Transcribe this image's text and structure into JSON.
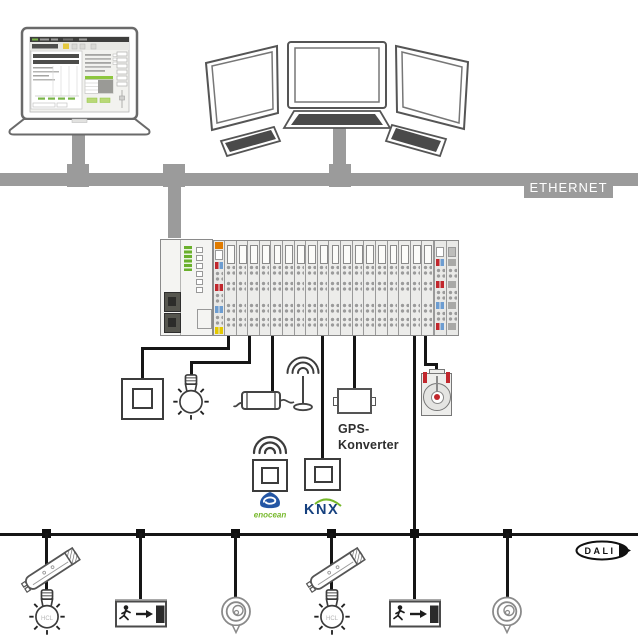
{
  "ethernet": {
    "label": "ETHERNET"
  },
  "gps_converter": {
    "label_line1": "GPS-",
    "label_line2": "Konverter"
  },
  "logos": {
    "enocean": {
      "text": "enocean",
      "shield_color": "#2456a4",
      "text_color": "#76b82a"
    },
    "knx": {
      "text": "KNX",
      "text_color": "#16417f",
      "arc_color": "#76b82a"
    },
    "dali": {
      "text": "DALI"
    }
  },
  "bulb_label": "HCL",
  "rack": {
    "terminal_slices": 18
  },
  "colors": {
    "ethernet_gray": "#9b9b9b",
    "cable_black": "#161616",
    "controller_green": "#6ab02c",
    "terminal_red": "#c1272d",
    "terminal_blue": "#6d9dd1",
    "terminal_yellow": "#e3c800",
    "terminal_orange": "#e07b00"
  }
}
